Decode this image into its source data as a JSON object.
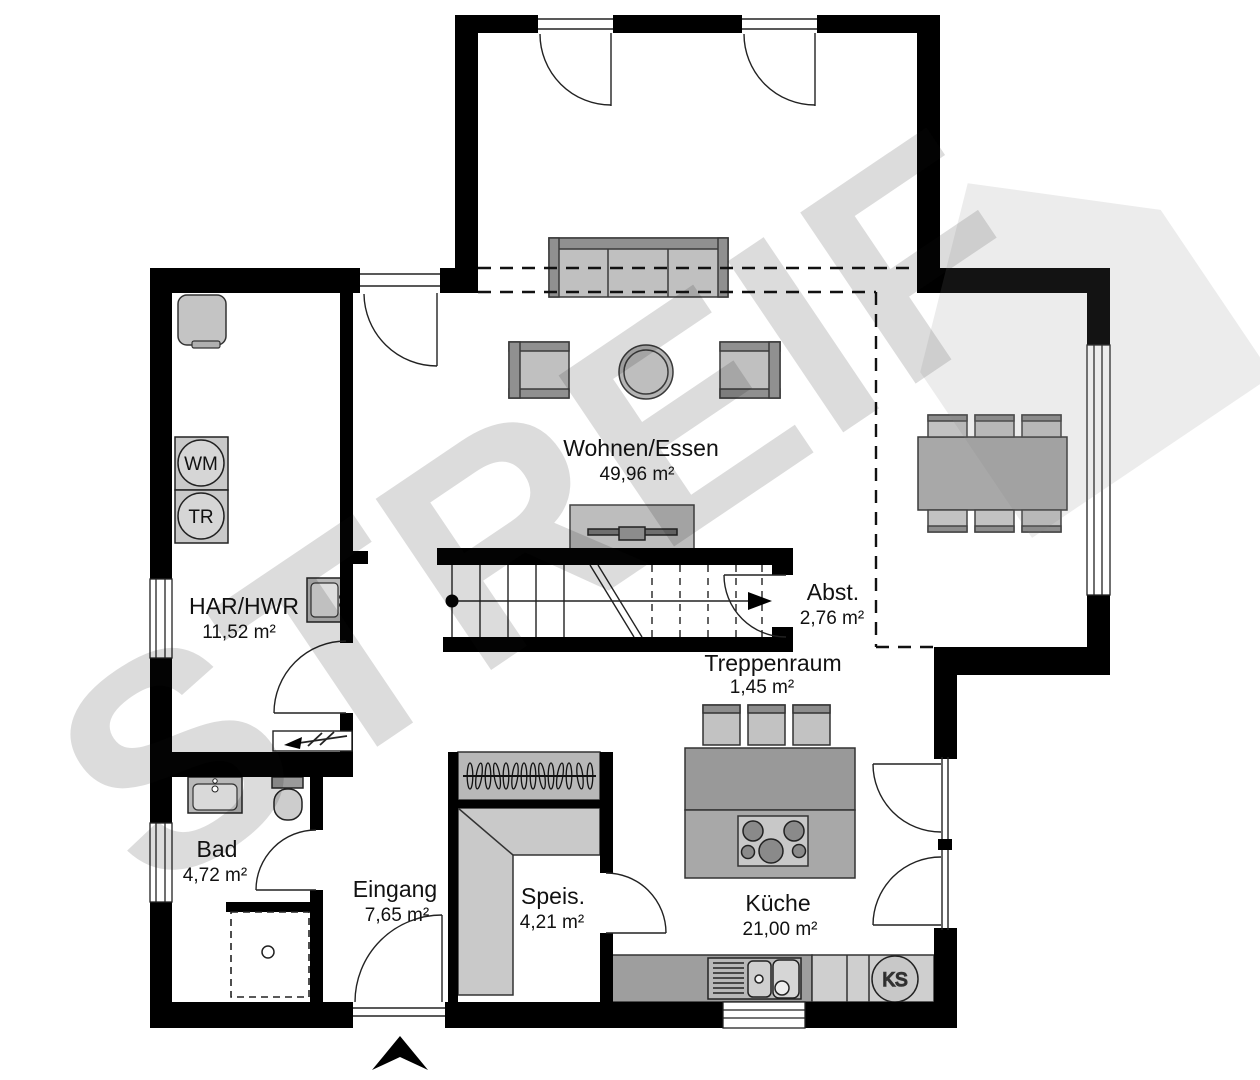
{
  "watermark": {
    "text": "STREIF"
  },
  "rooms": {
    "wohnen": {
      "name": "Wohnen/Essen",
      "area": "49,96 m²"
    },
    "har": {
      "name": "HAR/HWR",
      "area": "11,52 m²"
    },
    "abst": {
      "name": "Abst.",
      "area": "2,76 m²"
    },
    "treppenraum": {
      "name": "Treppenraum",
      "area": "1,45 m²"
    },
    "bad": {
      "name": "Bad",
      "area": "4,72 m²"
    },
    "eingang": {
      "name": "Eingang",
      "area": "7,65 m²"
    },
    "speis": {
      "name": "Speis.",
      "area": "4,21 m²"
    },
    "kueche": {
      "name": "Küche",
      "area": "21,00 m²"
    }
  },
  "appliances": {
    "washing_machine": "WM",
    "dryer": "TR",
    "fridge": "KS"
  },
  "colors": {
    "wall": "#000000",
    "furniture_light": "#c9c9c9",
    "furniture_mid": "#a8a8a8",
    "furniture_dark": "#8f8f8f"
  }
}
